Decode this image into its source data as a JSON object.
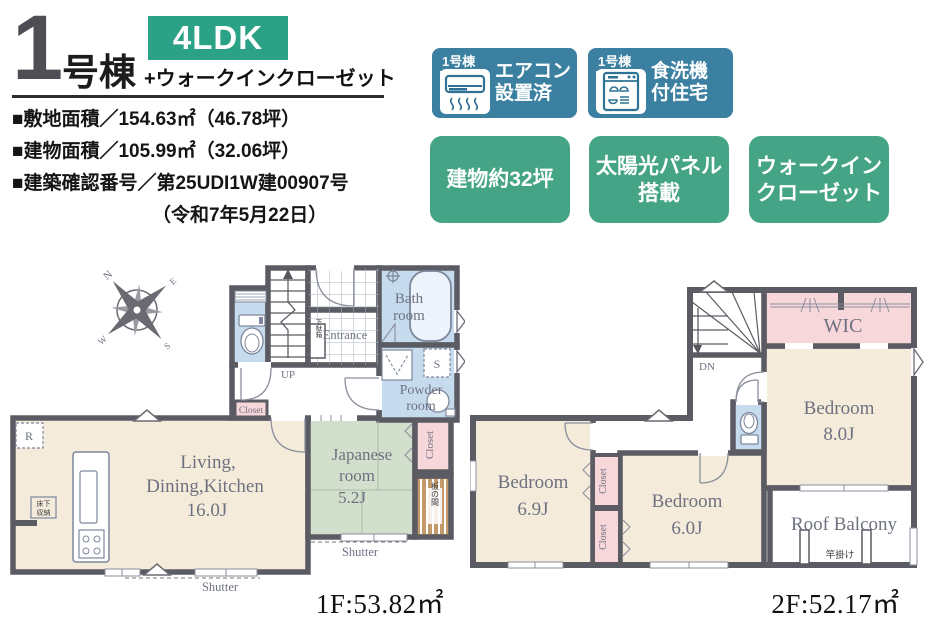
{
  "header": {
    "building_no": "1",
    "building_unit": "号棟",
    "plan_type": "4LDK",
    "plan_note": "+ウォークインクローゼット",
    "spec_lines": [
      "■敷地面積／154.63㎡（46.78坪）",
      "■建物面積／105.99㎡（32.06坪）",
      "■建築確認番号／第25UDI1W建00907号",
      "（令和7年5月22日）"
    ]
  },
  "badges": {
    "aircon": {
      "unit": "1号棟",
      "line1": "エアコン",
      "line2": "設置済"
    },
    "dishwasher": {
      "unit": "1号棟",
      "line1": "食洗機",
      "line2": "付住宅"
    },
    "green1": {
      "line1": "建物約32坪",
      "line2": ""
    },
    "green2": {
      "line1": "太陽光パネル",
      "line2": "搭載"
    },
    "green3": {
      "line1": "ウォークイン",
      "line2": "クローゼット"
    }
  },
  "floor1": {
    "area": "1F:53.82㎡",
    "compass": {
      "n": "N",
      "e": "E",
      "s": "S",
      "w": "W"
    },
    "labels": {
      "ldk1": "Living,",
      "ldk2": "Dining,Kitchen",
      "ldk3": "16.0J",
      "jp1": "Japanese",
      "jp2": "room",
      "jp3": "5.2J",
      "bath1": "Bath",
      "bath2": "room",
      "powder1": "Powder",
      "powder2": "room",
      "entrance": "Entrance",
      "up": "UP",
      "closet_hall": "Closet",
      "closet_jp": "Closet",
      "getabako": "下駄箱",
      "itanoma": "板の間",
      "yukashita1": "床下",
      "yukashita2": "収納",
      "fridge": "R",
      "washer": "S",
      "shutter_jp": "Shutter",
      "shutter_ldk": "Shutter"
    }
  },
  "floor2": {
    "area": "2F:52.17㎡",
    "labels": {
      "wic": "WIC",
      "dn": "DN",
      "bed8_1": "Bedroom",
      "bed8_2": "8.0J",
      "bed69_1": "Bedroom",
      "bed69_2": "6.9J",
      "bed6_1": "Bedroom",
      "bed6_2": "6.0J",
      "balcony": "Roof Balcony",
      "saokake": "竿掛け",
      "closet_u": "Closet",
      "closet_l": "Closet"
    }
  },
  "colors": {
    "badge_blue": "#3b7fa1",
    "badge_green": "#45a486",
    "plan_badge_green": "#2ba186",
    "wall": "#5b5b63",
    "room_beige": "#f4ebdb",
    "room_green": "#d2dfcc",
    "room_blue": "#c7dbee",
    "room_pink": "#f8d7db",
    "wood": "#c49a6a"
  }
}
